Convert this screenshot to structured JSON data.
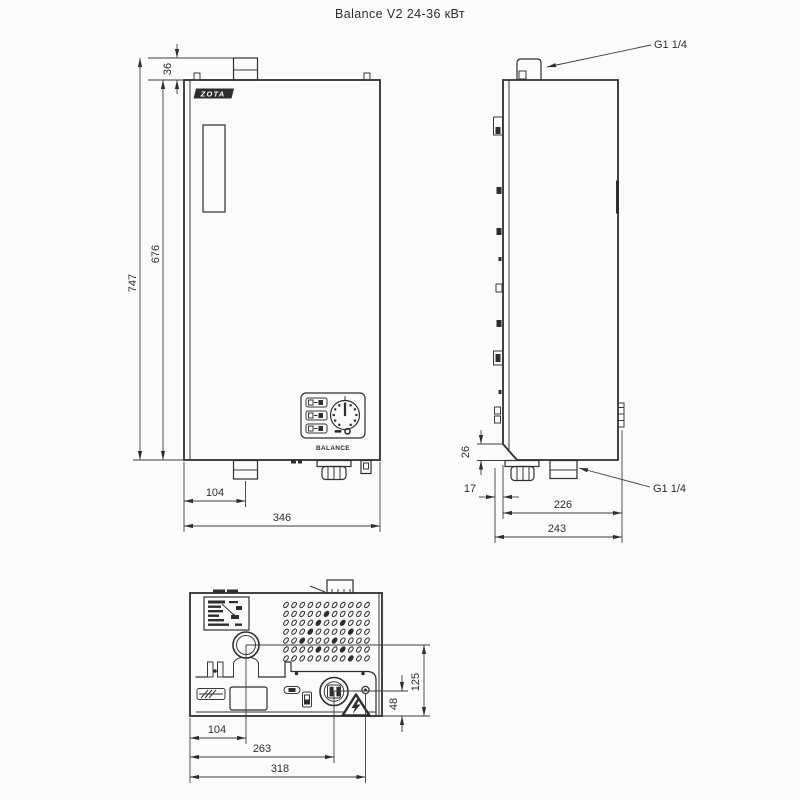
{
  "title": "Balance V2 24-36 кВт",
  "views": {
    "front": {
      "logo_text": "ZOTA",
      "panel_label": "BALANCE",
      "dims": {
        "pipe_height": "36",
        "total_height": "747",
        "body_height": "676",
        "pipe_offset": "104",
        "width": "346"
      }
    },
    "side": {
      "labels": {
        "fitting_top": "G1 1/4",
        "fitting_bottom": "G1 1/4"
      },
      "dims": {
        "chamfer": "26",
        "bracket_gap": "17",
        "depth": "226",
        "depth_total": "243"
      }
    },
    "bottom": {
      "dims": {
        "pipe_offset": "104",
        "connector_offset": "263",
        "screw_offset": "318",
        "recess_depth": "125",
        "panel_depth": "48"
      }
    }
  },
  "colors": {
    "line": "#2e2e2e",
    "dimension_line": "#3d3d3d",
    "background": "#fbfbfb"
  }
}
